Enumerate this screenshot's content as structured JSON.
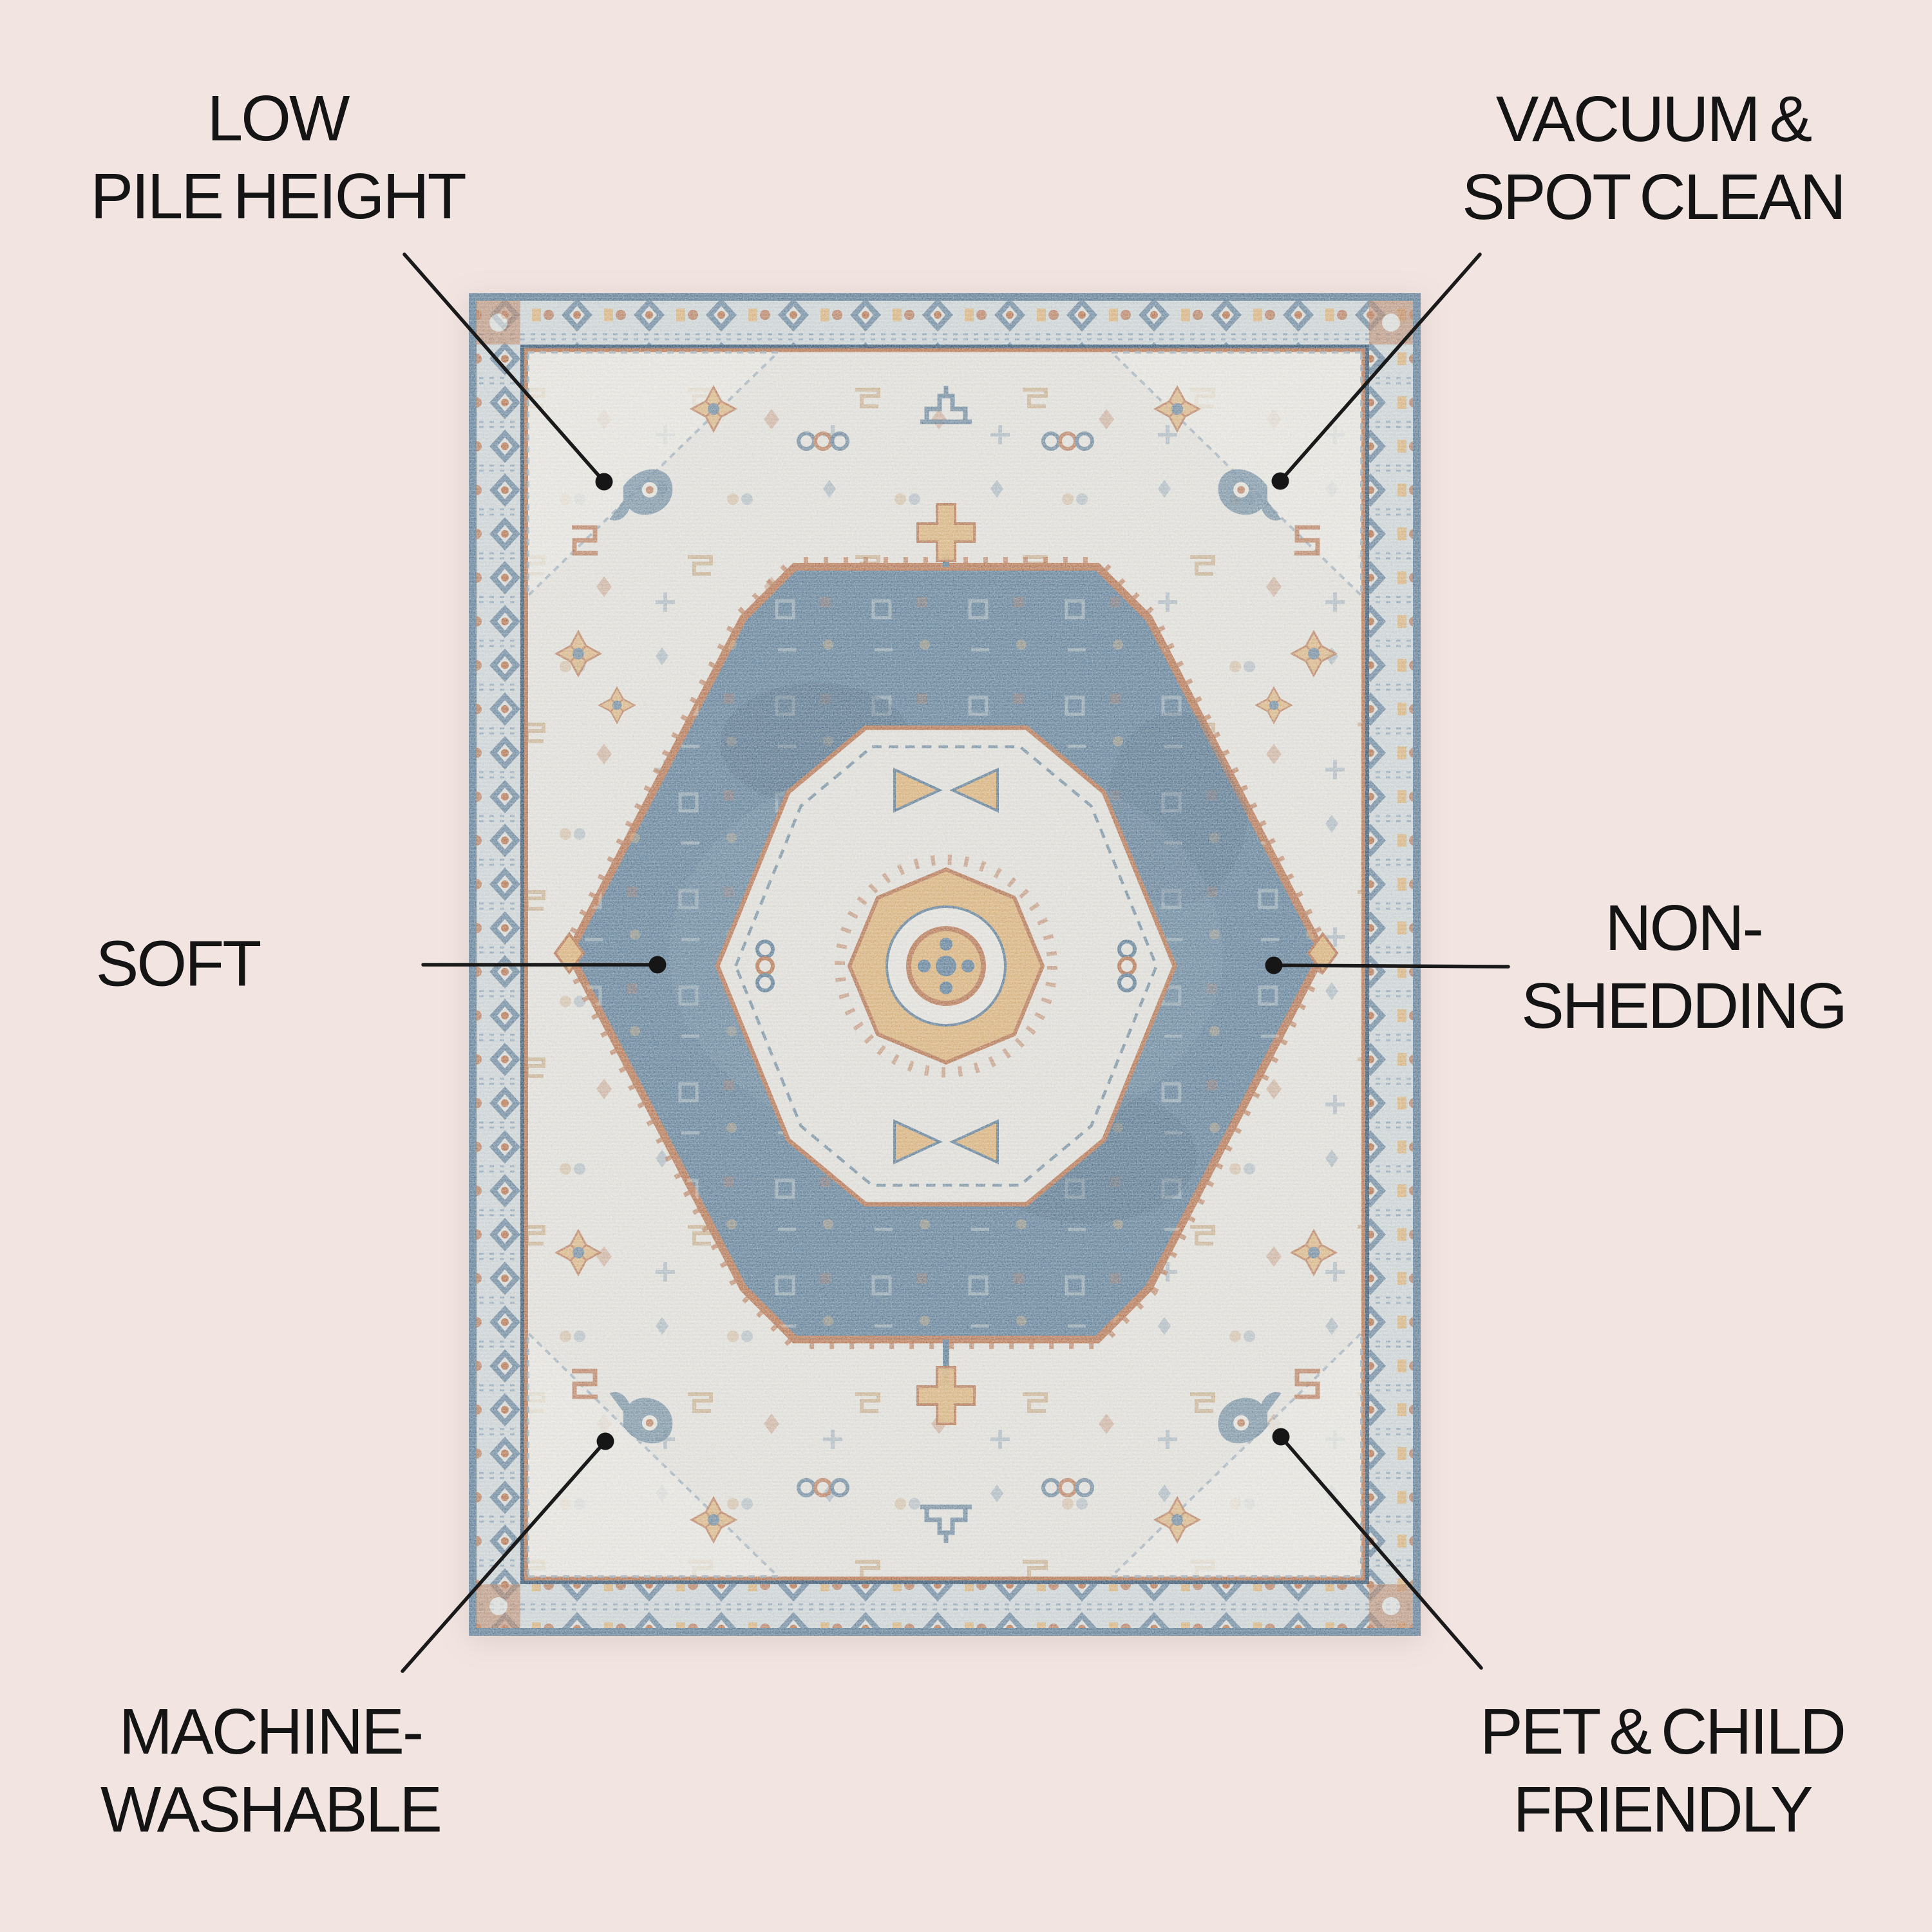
{
  "page": {
    "title": "Rug features infographic",
    "background_color": "#f2e5e1",
    "text_color": "#141414",
    "leader_line_color": "#1a1a1a"
  },
  "icons": {
    "callout_dot": "filled-circle"
  },
  "features": {
    "top_left": {
      "lines": [
        "LOW",
        "PILE HEIGHT"
      ]
    },
    "top_right": {
      "lines": [
        "VACUUM &",
        "SPOT CLEAN"
      ]
    },
    "mid_left": {
      "lines": [
        "SOFT"
      ]
    },
    "mid_right": {
      "lines": [
        "NON-",
        "SHEDDING"
      ]
    },
    "bottom_left": {
      "lines": [
        "MACHINE-",
        "WASHABLE"
      ]
    },
    "bottom_right": {
      "lines": [
        "PET & CHILD",
        "FRIENDLY"
      ]
    }
  },
  "rug": {
    "description": "Vintage-style medallion area rug in ivory, slate blue, rust and gold",
    "palette": {
      "field_ivory": "#e1dfd9",
      "border_grey_blue": "#ccd3d5",
      "slate_blue": "#5b7b95",
      "navy": "#33516c",
      "rust": "#b4714c",
      "gold": "#d9ae74"
    }
  }
}
